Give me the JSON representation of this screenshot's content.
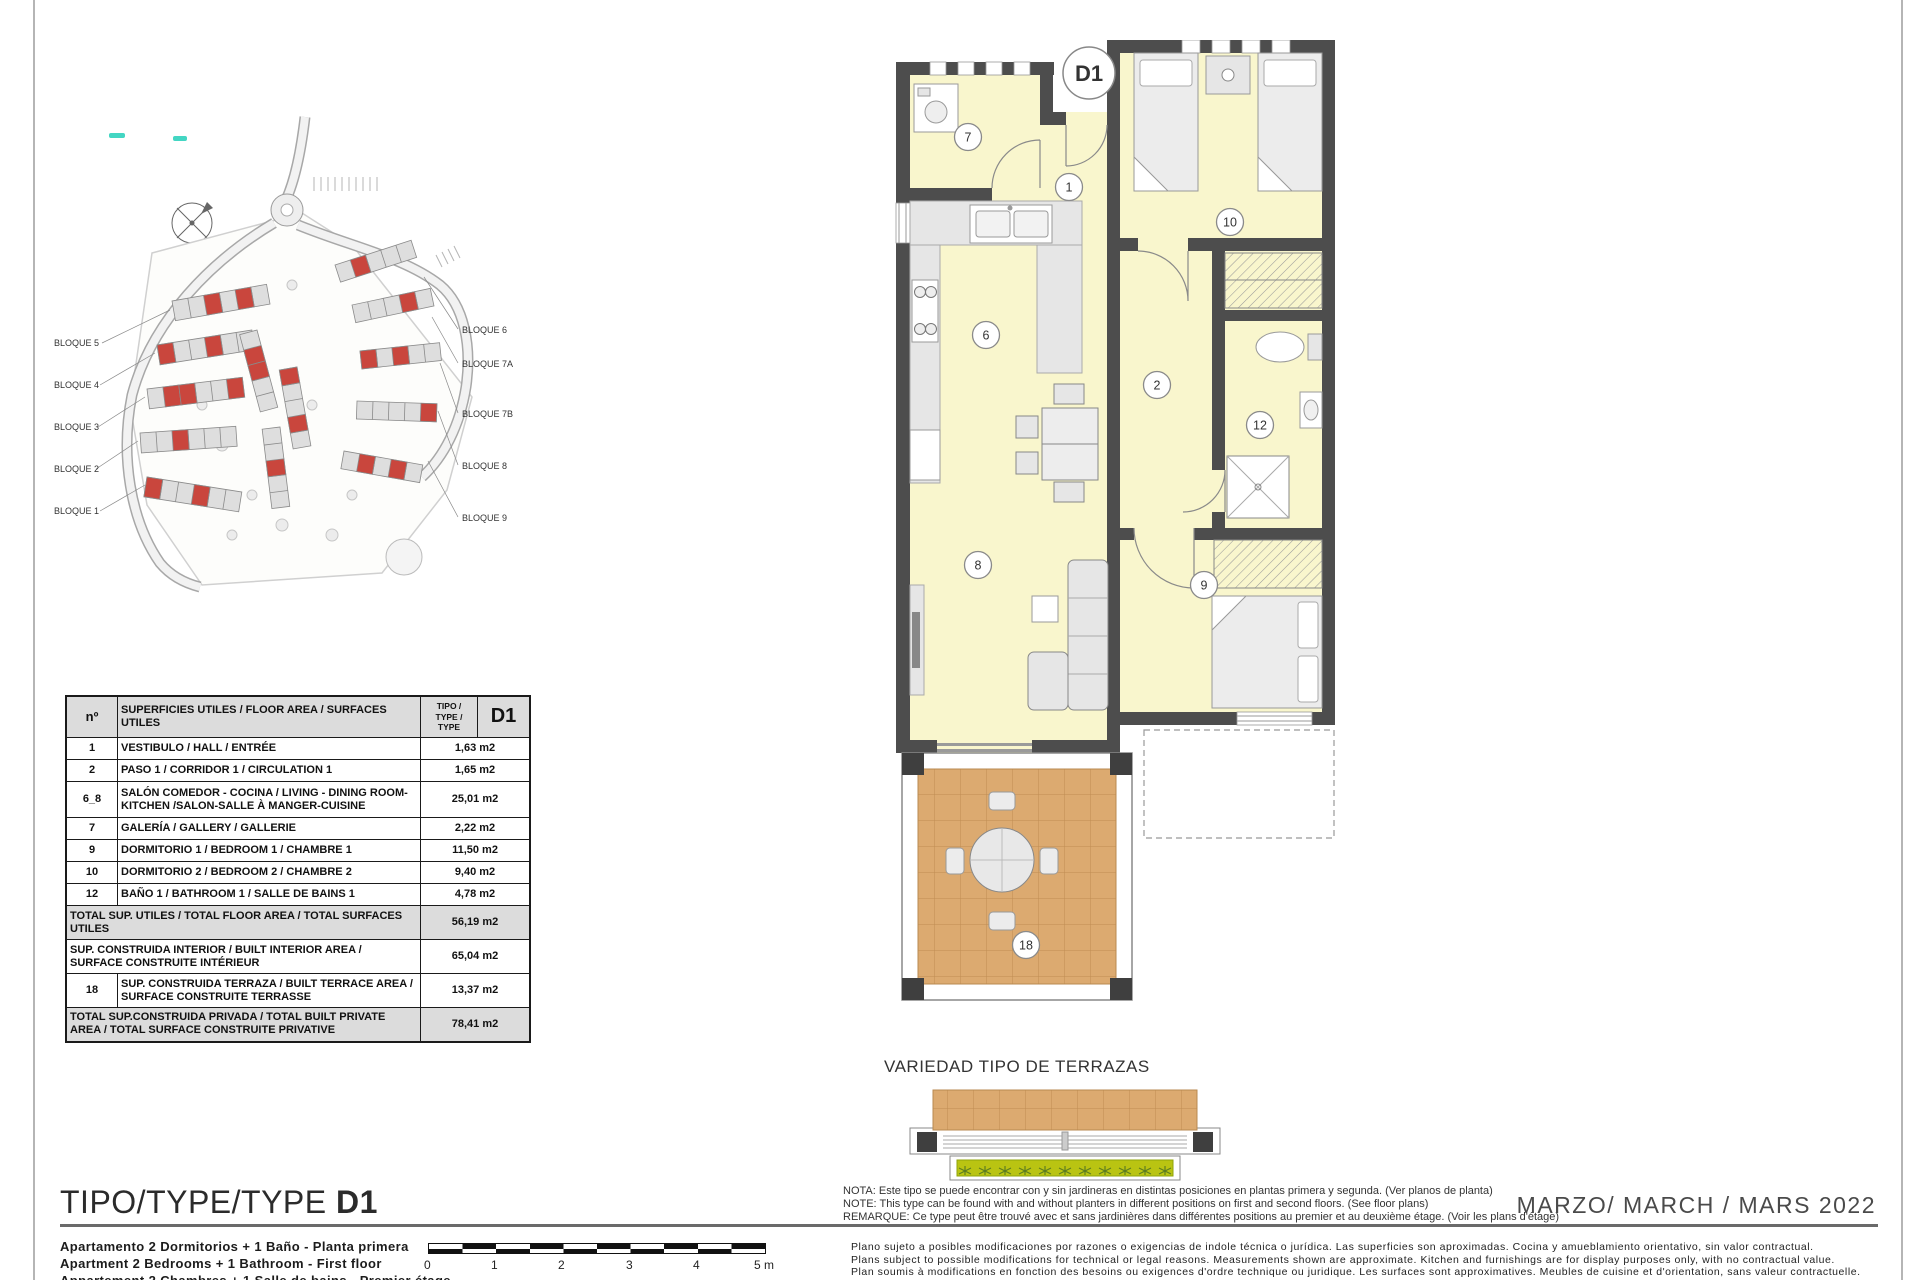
{
  "site_plan": {
    "blocks_left": [
      "BLOQUE 5",
      "BLOQUE 4",
      "BLOQUE 3",
      "BLOQUE 2",
      "BLOQUE 1"
    ],
    "blocks_right": [
      "BLOQUE 6",
      "BLOQUE 7A",
      "BLOQUE 7B",
      "BLOQUE 8",
      "BLOQUE 9"
    ]
  },
  "floor_plan": {
    "unit_label": "D1",
    "rooms": {
      "galeria": "7",
      "hall": "1",
      "bedroom2": "10",
      "kitchen": "6",
      "corridor": "2",
      "bathroom": "12",
      "living": "8",
      "bedroom1": "9",
      "terrace": "18"
    }
  },
  "areas_table": {
    "header": {
      "col_no": "nº",
      "col_desc": "SUPERFICIES UTILES / FLOOR AREA / SURFACES UTILES",
      "type_lines": [
        "TIPO /",
        "TYPE /",
        "TYPE"
      ],
      "col_code": "D1"
    },
    "rows": [
      {
        "no": "1",
        "desc": "VESTIBULO / HALL / ENTRÉE",
        "value": "1,63 m2"
      },
      {
        "no": "2",
        "desc": "PASO 1 / CORRIDOR 1 / CIRCULATION 1",
        "value": "1,65 m2"
      },
      {
        "no": "6_8",
        "desc": "SALÓN COMEDOR - COCINA / LIVING - DINING ROOM-KITCHEN /SALON-SALLE À MANGER-CUISINE",
        "value": "25,01 m2"
      },
      {
        "no": "7",
        "desc": "GALERÍA / GALLERY / GALLERIE",
        "value": "2,22 m2"
      },
      {
        "no": "9",
        "desc": "DORMITORIO 1 / BEDROOM 1 / CHAMBRE 1",
        "value": "11,50 m2"
      },
      {
        "no": "10",
        "desc": "DORMITORIO 2 / BEDROOM 2 / CHAMBRE 2",
        "value": "9,40 m2"
      },
      {
        "no": "12",
        "desc": "BAÑO 1 / BATHROOM 1 / SALLE DE BAINS 1",
        "value": "4,78 m2"
      }
    ],
    "summary": [
      {
        "desc": "TOTAL SUP. UTILES / TOTAL FLOOR AREA / TOTAL SURFACES UTILES",
        "value": "56,19 m2"
      },
      {
        "desc": "SUP. CONSTRUIDA INTERIOR / BUILT INTERIOR AREA / SURFACE CONSTRUITE INTÉRIEUR",
        "value": "65,04 m2"
      },
      {
        "no": "18",
        "desc": "SUP. CONSTRUIDA TERRAZA / BUILT TERRACE AREA / SURFACE CONSTRUITE TERRASSE",
        "value": "13,37 m2"
      },
      {
        "desc": "TOTAL SUP.CONSTRUIDA PRIVADA / TOTAL  BUILT PRIVATE AREA / TOTAL SURFACE CONSTRUITE PRIVATIVE",
        "value": "78,41 m2"
      }
    ]
  },
  "terrace_note": {
    "title": "VARIEDAD TIPO DE TERRAZAS",
    "lines": [
      "NOTA: Este tipo se puede encontrar con y sin jardineras en distintas posiciones en plantas primera y segunda. (Ver planos de planta)",
      "NOTE: This type can be found with and without planters in different positions on first and second floors. (See floor plans)",
      "REMARQUE: Ce type peut être trouvé avec et sans jardinières dans différentes positions au premier et au deuxième étage. (Voir les plans d'étage)"
    ]
  },
  "disclaimer": {
    "lines": [
      "Plano sujeto a posibles modificaciones por razones o exigencias de indole técnica o jurídica. Las superficies son aproximadas. Cocina y amueblamiento orientativo, sin valor contractual.",
      "Plans subject to possible modifications for technical or legal reasons. Measurements shown are approximate. Kitchen and furnishings are for display purposes only, with no contractual value.",
      "Plan soumis à modifications en fonction des besoins ou exigences d'ordre technique ou juridique. Les surfaces sont approximatives. Meubles de cuisine et d'orientation, sans valeur contractuelle."
    ]
  },
  "footer": {
    "title_label": "TIPO/TYPE/TYPE ",
    "title_code": "D1",
    "date": "MARZO/ MARCH / MARS  2022",
    "descriptor_lines": [
      "Apartamento 2 Dormitorios + 1 Baño - Planta primera",
      "Apartment 2 Bedrooms + 1 Bathroom - First floor",
      "Appartement 2 Chambres + 1 Salle de bains - Premier étage"
    ]
  },
  "scale_bar": {
    "labels": [
      "0",
      "1",
      "2",
      "3",
      "4",
      "5 m"
    ]
  },
  "colors": {
    "wall": "#4d4d4d",
    "room_fill": "#f9f6cd",
    "terrace_tile": "#dcaa70",
    "planter_green": "#b9c412",
    "highlight_red": "#c9463d",
    "teal_mark": "#43d6c3",
    "table_shade": "#dcdcdc"
  }
}
